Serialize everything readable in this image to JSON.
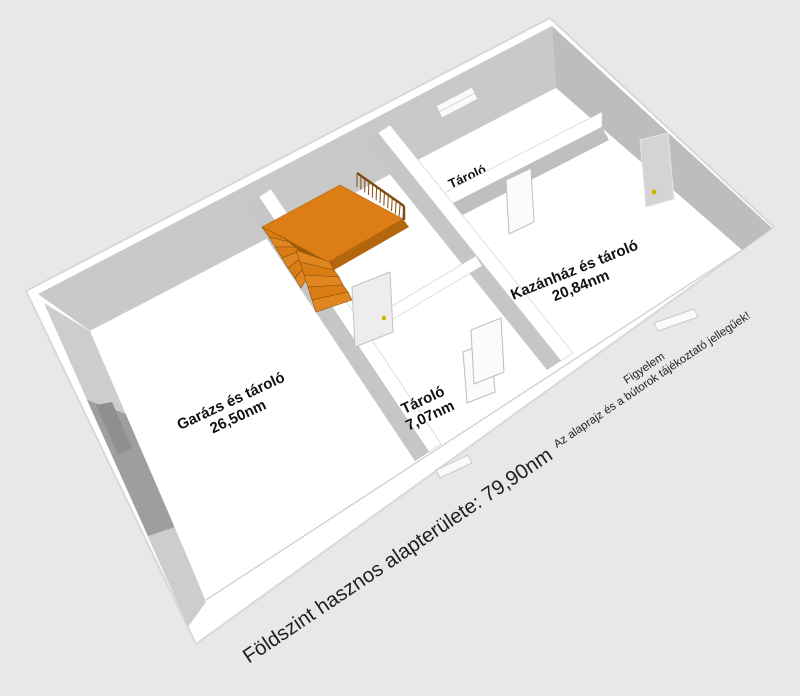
{
  "floorplan": {
    "background": "#e8e8e8",
    "rooms": [
      {
        "name": "Garázs és tároló",
        "area": "26,50nm"
      },
      {
        "name": "Tároló",
        "area": "7,07nm"
      },
      {
        "name": "Kazánház és tároló",
        "area": "20,84nm"
      },
      {
        "name": "Tároló",
        "area": ""
      }
    ],
    "summary": "Földszint hasznos alapterülete: 79,90nm",
    "disclaimer": {
      "title": "Figyelem",
      "text": "Az alaprajz és a bútorok tájékoztató jellegűek!"
    },
    "colors": {
      "wall_top": "#ffffff",
      "wall_inner_nw": "#c9c9c9",
      "wall_inner_ne": "#bdbdbd",
      "wall_inner_sw": "#cdcdcd",
      "garage_door": "#9e9e9e",
      "stair_top": "#DC7E15",
      "stair_dark": "#A05B0A",
      "stair_front": "#B4660C",
      "rail": "#7C4B12",
      "door_handle": "#c9b500"
    }
  }
}
